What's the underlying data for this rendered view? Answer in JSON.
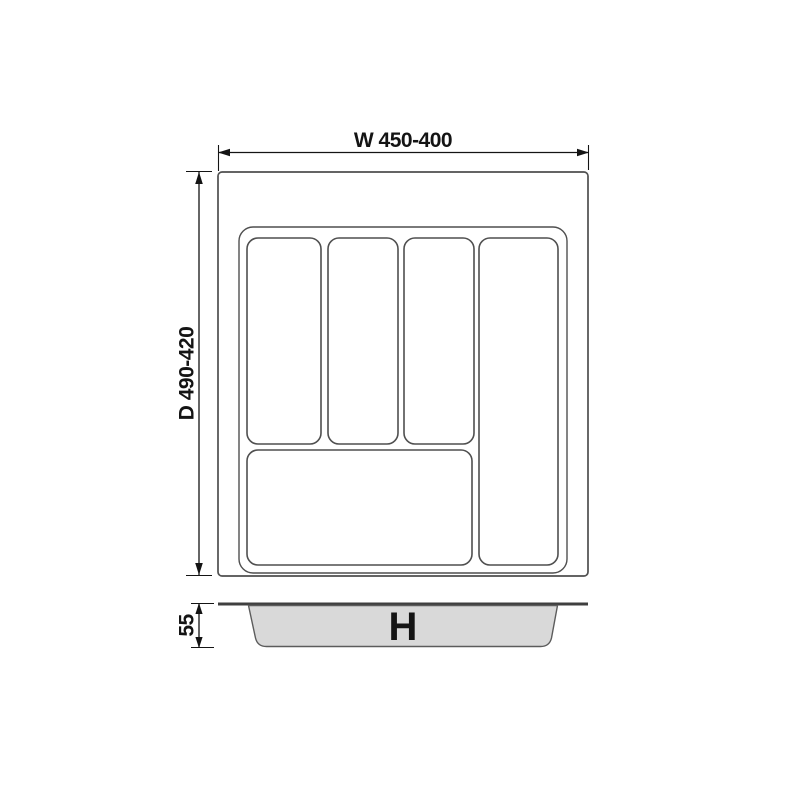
{
  "labels": {
    "width": "W 450-400",
    "depth": "D 490-420",
    "rim_height": "55",
    "tray_height": "H"
  },
  "colors": {
    "line": "#4f4f4f",
    "dimension": "#141414",
    "profile_fill": "#d9d9d9",
    "background": "#ffffff"
  }
}
